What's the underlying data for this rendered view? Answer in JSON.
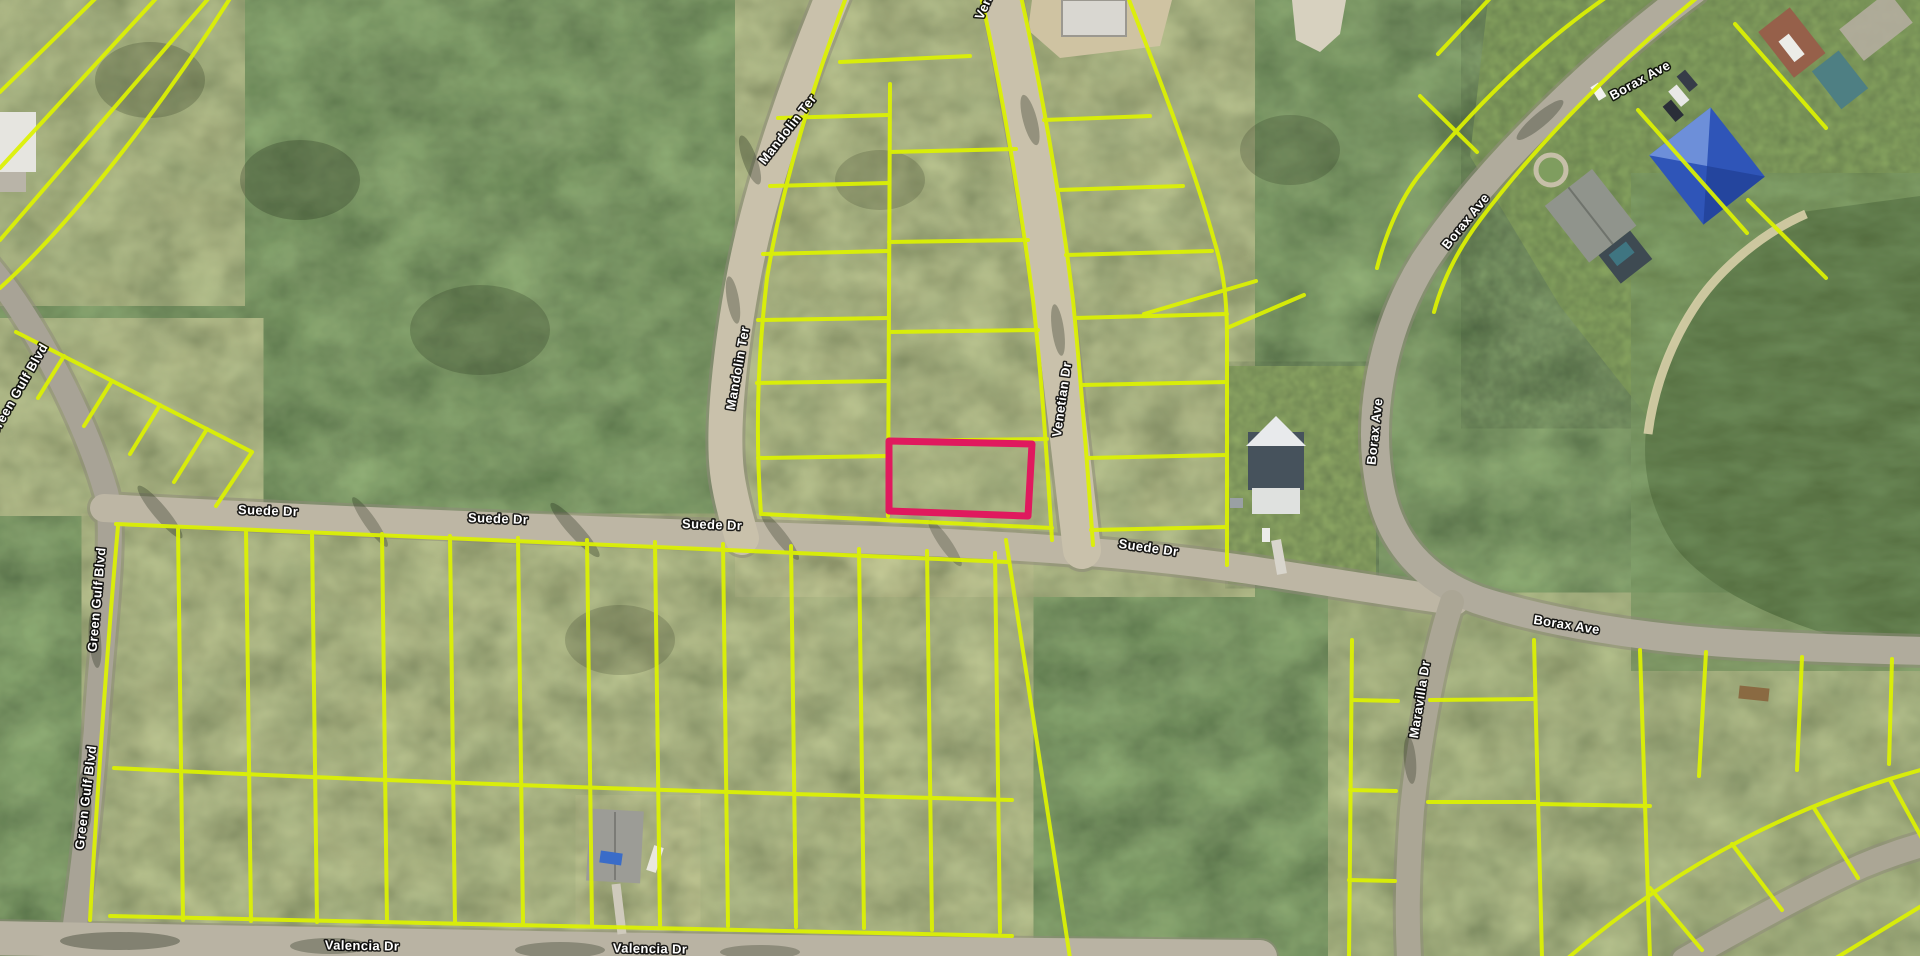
{
  "map": {
    "parcel_line_color": "#ddf202",
    "selected_parcel": {
      "color": "#e0195e"
    },
    "street_labels": [
      {
        "text": "Mandolin Ter"
      },
      {
        "text": "Mandolin Ter"
      },
      {
        "text": "Venetian Dr"
      },
      {
        "text": "Venetian Dr"
      },
      {
        "text": "Suede Dr"
      },
      {
        "text": "Suede Dr"
      },
      {
        "text": "Suede Dr"
      },
      {
        "text": "Suede Dr"
      },
      {
        "text": "Borax Ave"
      },
      {
        "text": "Borax Ave"
      },
      {
        "text": "Borax Ave"
      },
      {
        "text": "Borax Ave"
      },
      {
        "text": "Maravilla Dr"
      },
      {
        "text": "Valencia Dr"
      },
      {
        "text": "Valencia Dr"
      },
      {
        "text": "Green Gulf Blvd"
      },
      {
        "text": "Green Gulf Blvd"
      },
      {
        "text": "Green Gulf Blvd"
      }
    ]
  }
}
